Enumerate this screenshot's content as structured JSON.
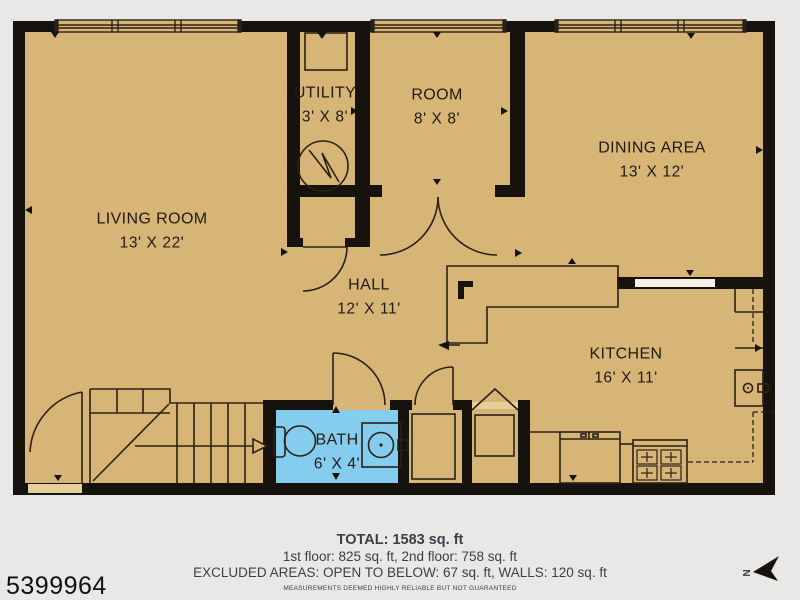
{
  "title": "First floor plan",
  "colors": {
    "background": "#e9e8e6",
    "floor": "#d6b577",
    "wall": "#16120d",
    "line": "#2a2115",
    "bath_floor": "#85cdee",
    "passthrough": "#f6f2e6",
    "sill": "#e6d098",
    "label_text": "#211b12",
    "footer_text": "#3b4046"
  },
  "rooms": [
    {
      "id": "living-room",
      "name": "LIVING ROOM",
      "dims": "13' X 22'"
    },
    {
      "id": "utility",
      "name": "UTILITY",
      "dims": "3' X 8'"
    },
    {
      "id": "room",
      "name": "ROOM",
      "dims": "8' X 8'"
    },
    {
      "id": "dining-area",
      "name": "DINING AREA",
      "dims": "13' X 12'"
    },
    {
      "id": "hall",
      "name": "HALL",
      "dims": "12' X 11'"
    },
    {
      "id": "kitchen",
      "name": "KITCHEN",
      "dims": "16' X 11'"
    },
    {
      "id": "bath",
      "name": "BATH",
      "dims": "6' X 4'"
    }
  ],
  "footer": {
    "total": "TOTAL: 1583 sq. ft",
    "floors": "1st floor: 825 sq. ft, 2nd floor: 758 sq. ft",
    "excluded": "EXCLUDED AREAS: OPEN TO BELOW: 67 sq. ft, WALLS: 120 sq. ft",
    "disclaimer": "MEASUREMENTS DEEMED HIGHLY RELIABLE BUT NOT GUARANTEED"
  },
  "watermark": "5399964",
  "compass": {
    "label": "N"
  }
}
